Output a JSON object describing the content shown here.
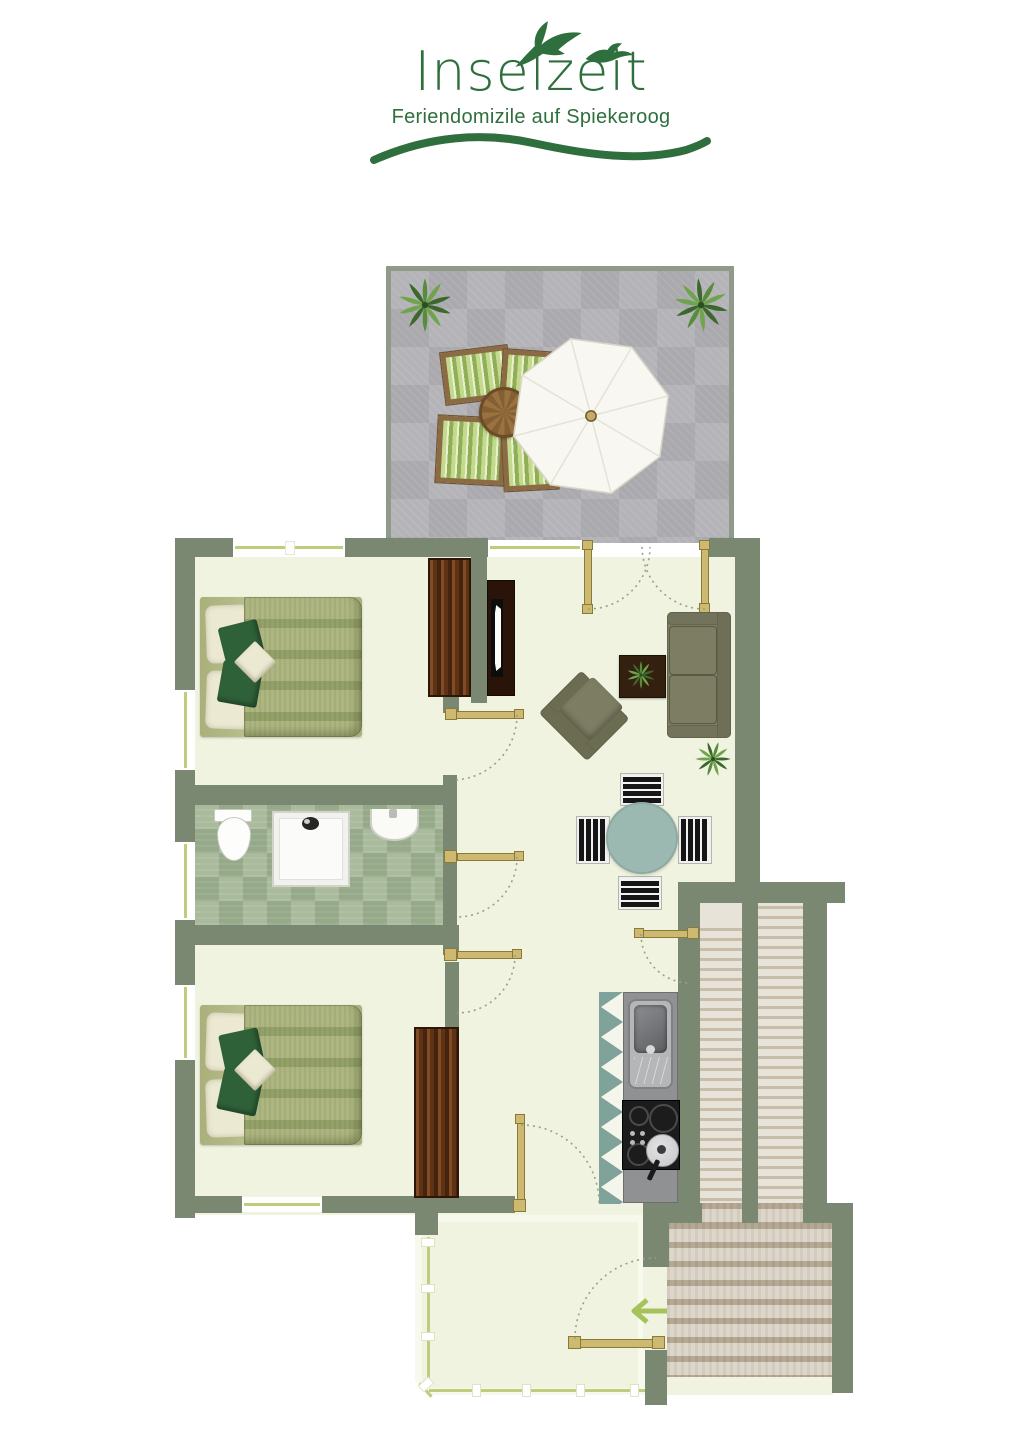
{
  "logo": {
    "title": "Inselzeit",
    "subtitle": "Feriendomizile auf Spiekeroog",
    "brand_color": "#2e6f3d"
  },
  "palette": {
    "brand": "#2e6f3d",
    "wall": "#7b8871",
    "floor": "#eff3e0",
    "floor_light": "#f7f9ec",
    "terrace_border": "#8f9a8b",
    "terrace_tile_a": "#b4b4b8",
    "terrace_tile_b": "#a9a9ae",
    "bath_tile_a": "#a9bb9c",
    "bath_tile_b": "#96a989",
    "window_line": "#bccd7b",
    "door_wood": "#cdb96f",
    "door_edge": "#8a7a3a",
    "arc_color": "#97a388",
    "bed_frame": "#a9b07a",
    "bed_stripe_a": "#adb681",
    "bed_stripe_b": "#93a168",
    "pillow": "#ece9d3",
    "pillow_green": "#2f6139",
    "wood_dark": "#5e3214",
    "wood_edge": "#2e1606",
    "tv_dark": "#2a140a",
    "sofa": "#7c7d62",
    "sofa_dark": "#63644c",
    "table_teal": "#9cb9b1",
    "stair_tread": "#e8e3d8",
    "stair_nose": "#c8bdab",
    "stair_tread2": "#ddd6c9",
    "stair_nose2": "#b5a994",
    "steel": "#b4b6b8",
    "steel_dark": "#7e8082",
    "hob": "#1c1c1c",
    "plant_dark": "#3d682c",
    "plant_mid": "#578c3b",
    "plant_light": "#6fa34c",
    "arrow_green": "#a6c35b",
    "parasol": "#f8f7f1",
    "outdoor_wood": "#8a6b44"
  },
  "floorplan": {
    "areas": [
      "terrace",
      "living-dining-room",
      "bedroom-1",
      "bathroom",
      "bedroom-2",
      "kitchen",
      "sunroom-entry",
      "staircase"
    ],
    "furniture": [
      "parasol",
      "outdoor-table",
      "outdoor-chairs",
      "potted-plants",
      "double-bed",
      "wardrobe",
      "tv-sideboard",
      "sofa",
      "armchair",
      "coffee-table",
      "round-dining-table",
      "dining-chairs",
      "toilet",
      "shower",
      "washbasin",
      "kitchen-sink",
      "cooktop-with-pan"
    ],
    "icons": {
      "seagulls-icon": "two seagull silhouettes",
      "wave-icon": "green wave swoosh",
      "plant-icon": "leafy plant starburst",
      "parasol-icon": "white octagonal parasol",
      "entry-arrow-icon": "←"
    }
  }
}
